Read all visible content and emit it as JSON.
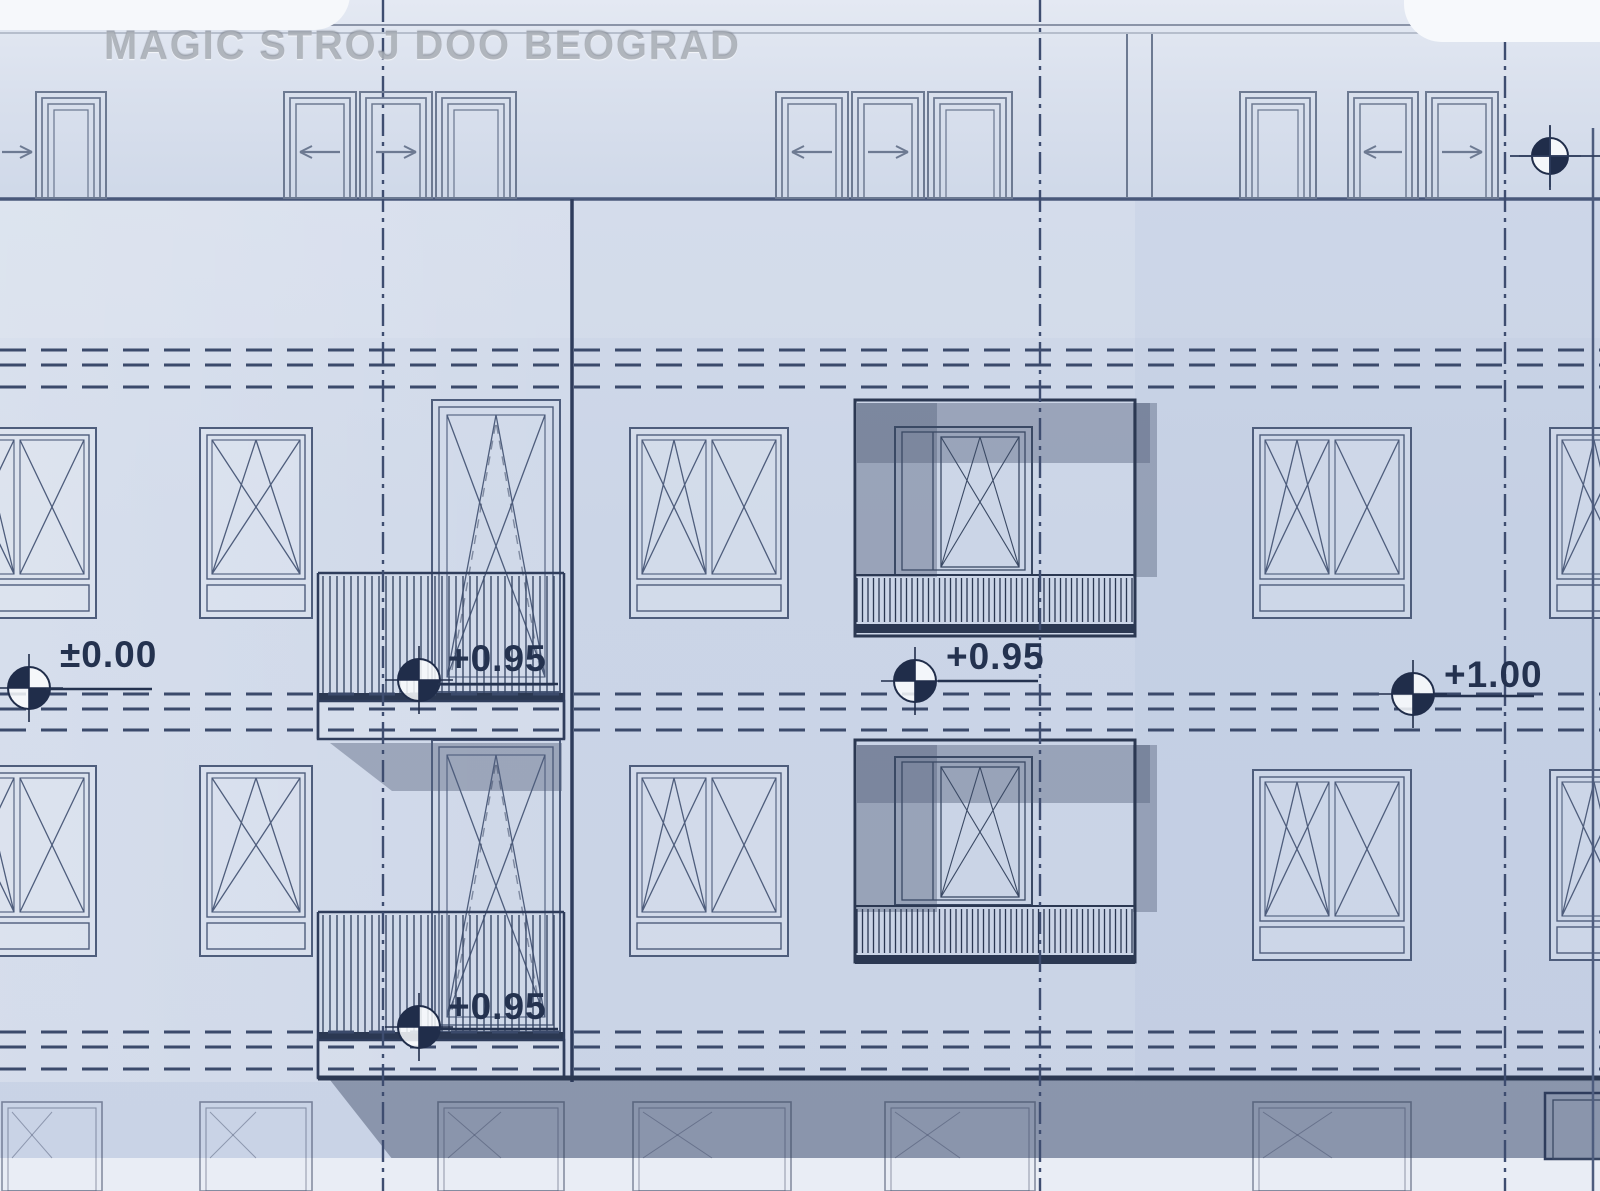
{
  "watermark": "MAGIC STROJ DOO BEOGRAD",
  "markers": {
    "origin": {
      "label": "±0.00"
    },
    "balcony_upper": {
      "label": "+0.95"
    },
    "loggia": {
      "label": "+0.95"
    },
    "balcony_lower": {
      "label": "+0.95"
    },
    "right": {
      "label": "+1.00"
    }
  },
  "icons": {
    "benchmark": "survey-benchmark-icon"
  },
  "colors": {
    "line_dark": "#2b3852",
    "line_med": "#4e5d7c",
    "line_light": "#6d7a92",
    "dash": "#3b4a6b",
    "axis": "#3e4d70",
    "benchmark": "#202d4a",
    "shadow": "rgba(84,96,122,0.42)",
    "shadow_deep": "rgba(76,88,114,0.50)",
    "facade": "#ccd6e8",
    "band_light": "#e9edf5",
    "text": "#24324f",
    "watermark_text": "rgba(128,134,146,0.55)"
  }
}
